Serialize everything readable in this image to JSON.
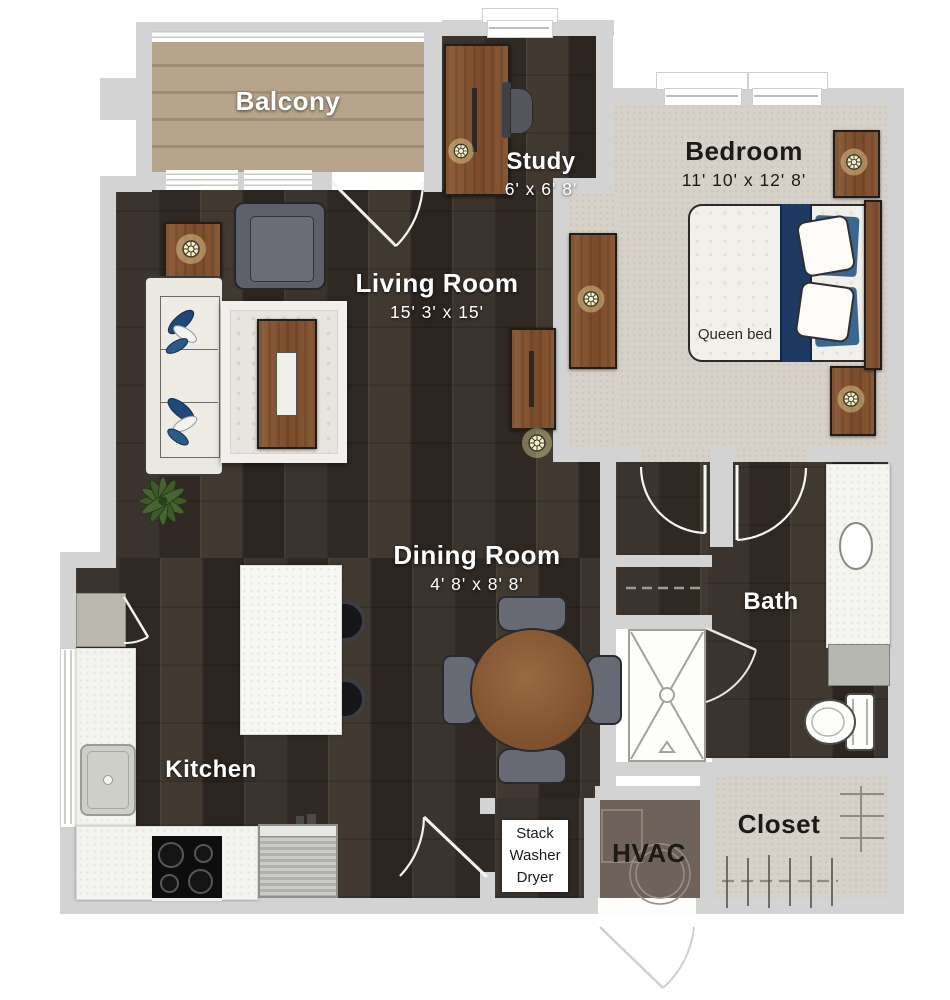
{
  "rooms": {
    "balcony": {
      "name": "Balcony"
    },
    "study": {
      "name": "Study",
      "dims": "6' x 6' 8'"
    },
    "bedroom": {
      "name": "Bedroom",
      "dims": "11' 10' x 12' 8'"
    },
    "living_room": {
      "name": "Living Room",
      "dims": "15' 3' x 15'"
    },
    "dining_room": {
      "name": "Dining Room",
      "dims": "4' 8' x 8' 8'"
    },
    "kitchen": {
      "name": "Kitchen"
    },
    "bath": {
      "name": "Bath"
    },
    "closet": {
      "name": "Closet"
    },
    "hvac": {
      "name": "HVAC"
    },
    "laundry": {
      "lines": [
        "Stack",
        "Washer",
        "Dryer"
      ]
    }
  },
  "furniture": {
    "queen_bed_label": "Queen bed"
  },
  "colors": {
    "wall": "#d3d3d3",
    "dark_wood": "#362e29",
    "carpet": "#d6d2c9",
    "balcony_wood": "#b3a088",
    "hvac_floor": "#6f625a",
    "navy": "#1e3a63",
    "accent_blue": "#3a678f",
    "furniture_wood": "#8a5836"
  }
}
